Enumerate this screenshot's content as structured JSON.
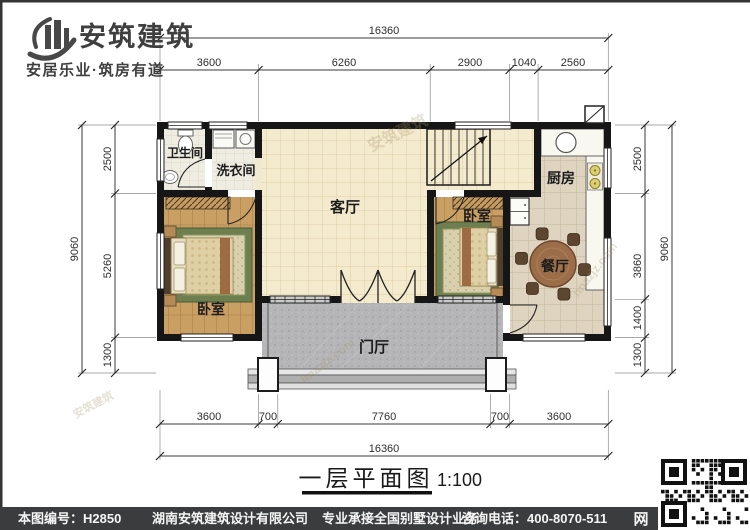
{
  "logo": {
    "name": "安筑建筑",
    "tagline": "安居乐业·筑房有道"
  },
  "rooms": {
    "bathroom": "卫生间",
    "laundry": "洗衣间",
    "living": "客厅",
    "kitchen": "厨房",
    "bedroom_left": "卧室",
    "bedroom_right": "卧室",
    "dining": "餐厅",
    "foyer": "门厅"
  },
  "dims": {
    "top_total": "16360",
    "top": [
      "3600",
      "6260",
      "2900",
      "1040",
      "2560"
    ],
    "left_total": "9060",
    "left": [
      "2500",
      "5260",
      "1300"
    ],
    "right_total": "9060",
    "right": [
      "2500",
      "3860",
      "1400",
      "1300"
    ],
    "bottom_total": "16360",
    "bottom": [
      "3600",
      "700",
      "7760",
      "700",
      "3600"
    ]
  },
  "title": {
    "text": "一层平面图",
    "scale": "1:100"
  },
  "footer": {
    "drawing_no": "本图编号：H2850",
    "company": "湖南安筑建筑设计有限公司",
    "services": "专业承接全国别墅设计业务",
    "phone": "咨询电话：400-8070-511",
    "net": "网"
  },
  "watermarks": {
    "brand": "安筑建筑",
    "site": "hnazjz.com"
  },
  "colors": {
    "wall": "#161616",
    "wood": "#c99f63",
    "tile_living": "#f4ebce",
    "tile_kitchen": "#ded4c0",
    "porch": "#b5b5b7",
    "bar": "#3b3c3e"
  }
}
